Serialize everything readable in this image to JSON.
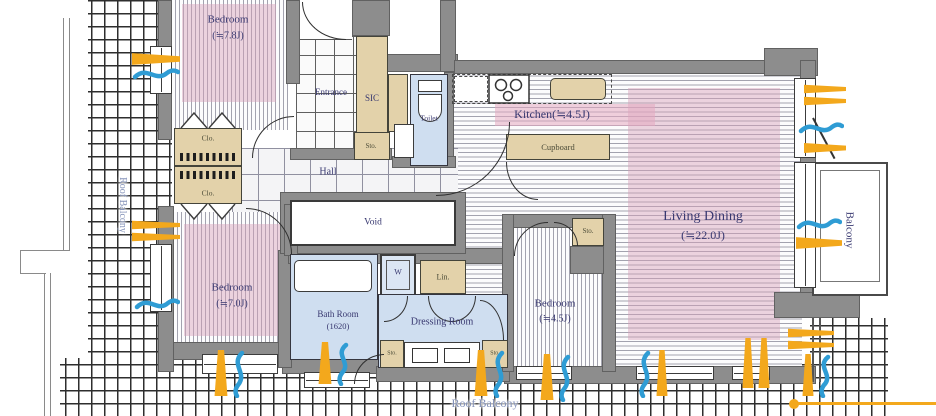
{
  "rooms": {
    "bedroom_78": {
      "name": "Bedroom",
      "size": "(≒7.8J)"
    },
    "bedroom_70": {
      "name": "Bedroom",
      "size": "(≒7.0J)"
    },
    "bedroom_45": {
      "name": "Bedroom",
      "size": "(≒4.5J)"
    },
    "living_dining": {
      "name": "Living Dining",
      "size": "(≒22.0J)"
    },
    "kitchen": {
      "name": "Kitchen(≒4.5J)"
    },
    "entrance": {
      "name": "Entrance"
    },
    "sic": {
      "name": "SIC"
    },
    "toilet": {
      "name": "Toilet"
    },
    "hall": {
      "name": "Hall"
    },
    "void": {
      "name": "Void"
    },
    "bath": {
      "name": "Bath Room",
      "size": "(1620)"
    },
    "dressing": {
      "name": "Dressing Room"
    },
    "balcony": {
      "name": "Balcony"
    },
    "roof_balcony_left": {
      "name": "Roof Balcony"
    },
    "roof_balcony_bottom": {
      "name": "Roof Balcony"
    }
  },
  "storage": {
    "entrance_sto": "Sto.",
    "closet_upper": "Clo.",
    "closet_lower": "Clo.",
    "cupboard": "Cupboard",
    "washer": "W",
    "linen": "Lin.",
    "dressing_sto_left": "Sto.",
    "dressing_sto_right": "Sto.",
    "bedroom45_sto": "Sto."
  },
  "colors": {
    "wall": "#8d8d8d",
    "tan_fixture": "#e3d2aa",
    "wet_room_blue": "#cfdef0",
    "floor_pink": "#d9a8bf",
    "sun_arrow": "#f3a81c",
    "wind_arrow": "#2f9cd4",
    "label_navy": "#383870",
    "roof_label": "#8593ba"
  }
}
